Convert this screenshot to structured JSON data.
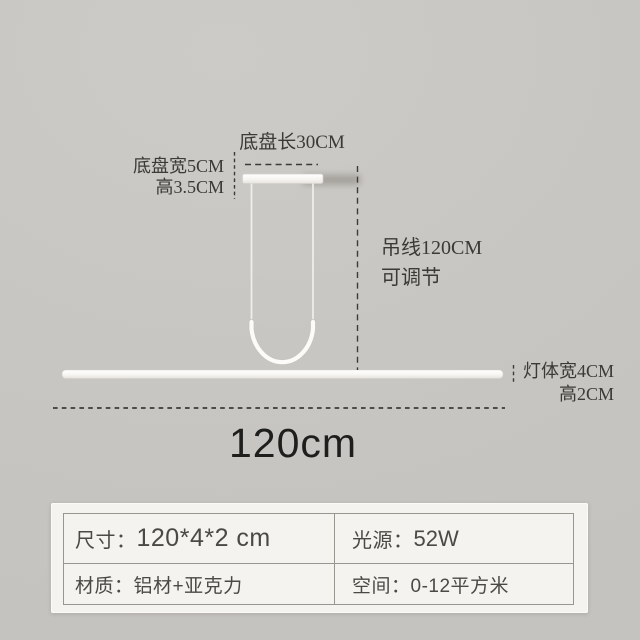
{
  "page": {
    "background_color": "#c8c6c2",
    "type_note": "product dimension diagram of linear LED pendant lamp"
  },
  "diagram": {
    "labels": {
      "base_plate_length": "底盘长30CM",
      "base_plate_width": "底盘宽5CM",
      "base_plate_height": "高3.5CM",
      "suspension_wire_length": "吊线120CM",
      "suspension_wire_note": "可调节",
      "lamp_body_width": "灯体宽4CM",
      "lamp_body_height": "高2CM",
      "overall_length": "120cm"
    },
    "colors": {
      "lamp_white": "#fbfaf8",
      "dimension_line": "#3c3b39",
      "annotation_text": "#3b3a37",
      "overall_length_text": "#1e1e1d"
    }
  },
  "spec_table": {
    "rows": [
      {
        "cells": [
          {
            "label": "尺寸：",
            "value": "120*4*2 cm"
          },
          {
            "label": "光源：",
            "value": "52W"
          }
        ]
      },
      {
        "cells": [
          {
            "label": "材质：",
            "value": "铝材+亚克力"
          },
          {
            "label": "空间：",
            "value": "0-12平方米"
          }
        ]
      }
    ],
    "colors": {
      "panel_background": "#f4f3ef",
      "border": "#99968f",
      "text": "#4a4946"
    }
  }
}
